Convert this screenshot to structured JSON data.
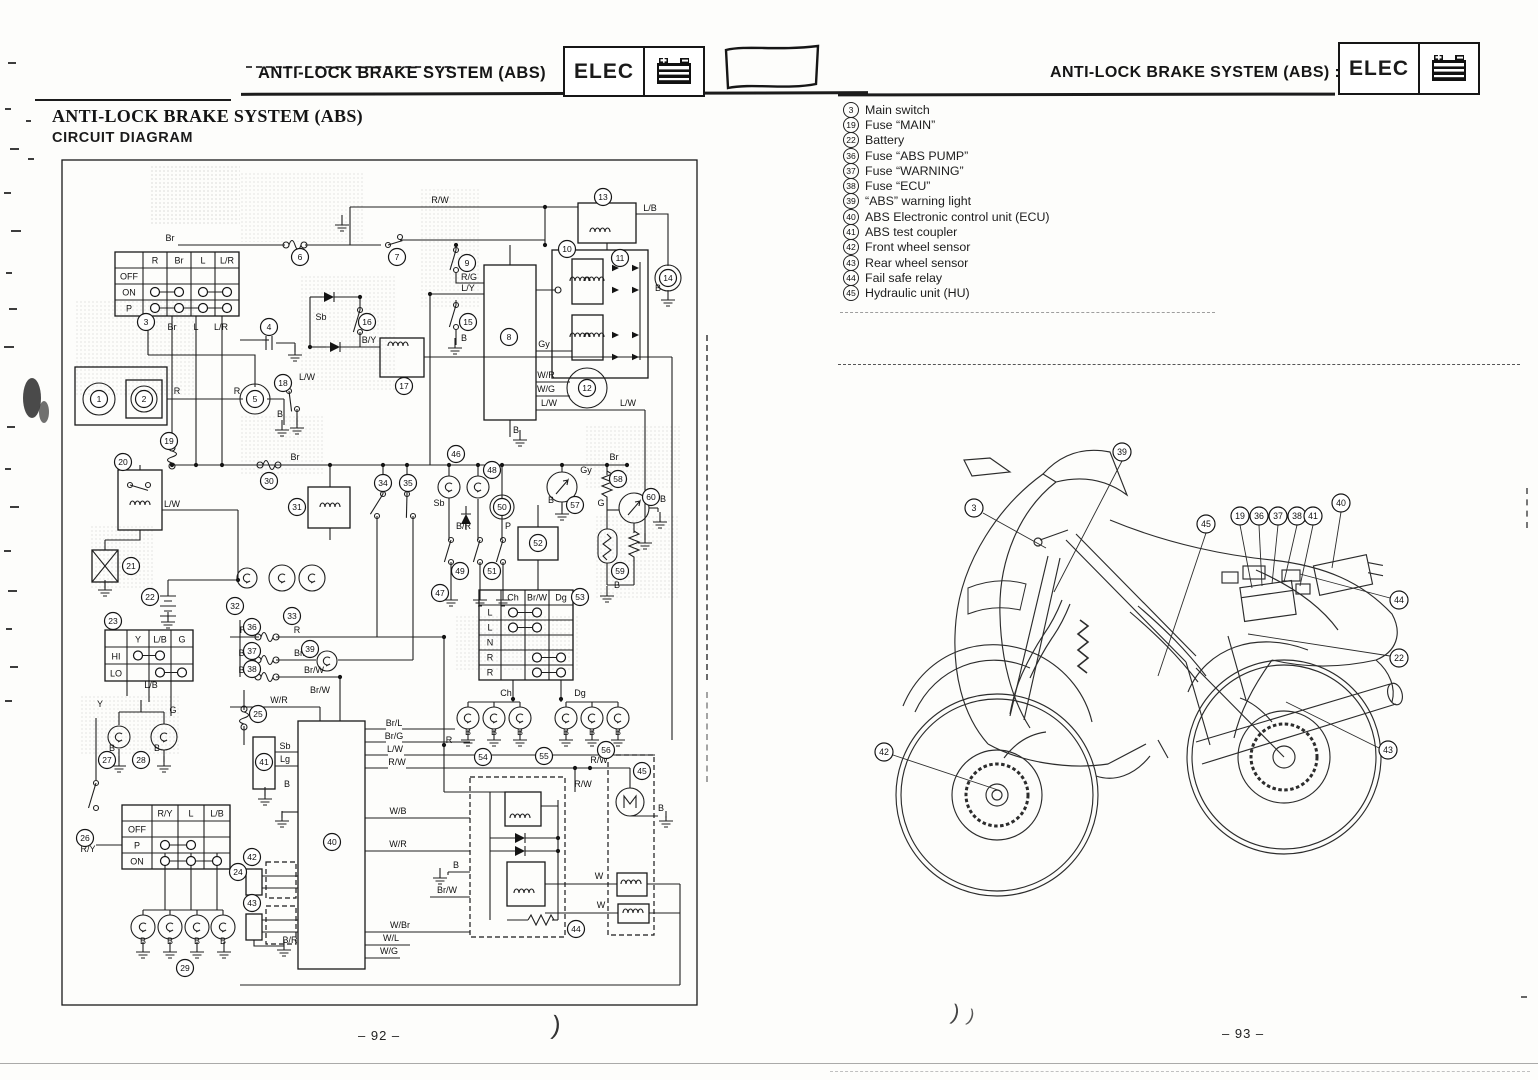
{
  "page_left": {
    "header_title": "ANTI-LOCK BRAKE SYSTEM (ABS)",
    "badge_label": "ELEC",
    "title_line1": "ANTI-LOCK BRAKE SYSTEM (ABS)",
    "title_line2": "CIRCUIT DIAGRAM",
    "page_number": "– 92 –"
  },
  "page_right": {
    "header_title": "ANTI-LOCK BRAKE SYSTEM (ABS) :",
    "badge_label": "ELEC",
    "page_number": "– 93 –",
    "legend": [
      {
        "num": "3",
        "label": "Main switch"
      },
      {
        "num": "19",
        "label": "Fuse “MAIN”"
      },
      {
        "num": "22",
        "label": "Battery"
      },
      {
        "num": "36",
        "label": "Fuse “ABS PUMP”"
      },
      {
        "num": "37",
        "label": "Fuse “WARNING”"
      },
      {
        "num": "38",
        "label": "Fuse “ECU”"
      },
      {
        "num": "39",
        "label": "“ABS” warning light"
      },
      {
        "num": "40",
        "label": "ABS Electronic control unit (ECU)"
      },
      {
        "num": "41",
        "label": "ABS test coupler"
      },
      {
        "num": "42",
        "label": "Front wheel sensor"
      },
      {
        "num": "43",
        "label": "Rear wheel sensor"
      },
      {
        "num": "44",
        "label": "Fail safe relay"
      },
      {
        "num": "45",
        "label": "Hydraulic unit (HU)"
      }
    ]
  },
  "circuit": {
    "callouts": [
      [
        1,
        99,
        399
      ],
      [
        2,
        144,
        399
      ],
      [
        3,
        146,
        322
      ],
      [
        4,
        269,
        327
      ],
      [
        5,
        255,
        399
      ],
      [
        6,
        300,
        257
      ],
      [
        7,
        397,
        257
      ],
      [
        8,
        509,
        337
      ],
      [
        9,
        467,
        263
      ],
      [
        10,
        567,
        249
      ],
      [
        11,
        620,
        258
      ],
      [
        12,
        587,
        388
      ],
      [
        13,
        603,
        197
      ],
      [
        14,
        668,
        278
      ],
      [
        15,
        468,
        322
      ],
      [
        16,
        367,
        322
      ],
      [
        17,
        404,
        386
      ],
      [
        18,
        283,
        383
      ],
      [
        19,
        169,
        441
      ],
      [
        20,
        123,
        462
      ],
      [
        21,
        131,
        566
      ],
      [
        22,
        150,
        597
      ],
      [
        23,
        113,
        621
      ],
      [
        24,
        238,
        872
      ],
      [
        25,
        258,
        714
      ],
      [
        26,
        85,
        838
      ],
      [
        27,
        107,
        760
      ],
      [
        28,
        141,
        760
      ],
      [
        29,
        185,
        968
      ],
      [
        30,
        269,
        481
      ],
      [
        31,
        297,
        507
      ],
      [
        32,
        235,
        606
      ],
      [
        33,
        292,
        616
      ],
      [
        34,
        383,
        483
      ],
      [
        35,
        408,
        483
      ],
      [
        36,
        252,
        627
      ],
      [
        37,
        252,
        651
      ],
      [
        38,
        252,
        669
      ],
      [
        39,
        310,
        649
      ],
      [
        40,
        332,
        842
      ],
      [
        41,
        264,
        762
      ],
      [
        42,
        252,
        857
      ],
      [
        43,
        252,
        903
      ],
      [
        44,
        576,
        929
      ],
      [
        45,
        642,
        771
      ],
      [
        46,
        456,
        454
      ],
      [
        47,
        440,
        593
      ],
      [
        48,
        492,
        470
      ],
      [
        49,
        460,
        571
      ],
      [
        50,
        502,
        507
      ],
      [
        51,
        492,
        571
      ],
      [
        52,
        538,
        543
      ],
      [
        53,
        580,
        597
      ],
      [
        54,
        483,
        757
      ],
      [
        55,
        544,
        756
      ],
      [
        56,
        606,
        750
      ],
      [
        57,
        575,
        505
      ],
      [
        58,
        618,
        479
      ],
      [
        59,
        620,
        571
      ],
      [
        60,
        651,
        497
      ]
    ],
    "labels": [
      [
        "R/W",
        440,
        203
      ],
      [
        "L/B",
        650,
        211
      ],
      [
        "Br",
        170,
        241
      ],
      [
        "R/G",
        469,
        280
      ],
      [
        "L/Y",
        468,
        291
      ],
      [
        "B",
        464,
        341
      ],
      [
        "Sb",
        321,
        320
      ],
      [
        "B/Y",
        369,
        343
      ],
      [
        "L/W",
        307,
        380
      ],
      [
        "B",
        280,
        417
      ],
      [
        "Gy",
        544,
        347
      ],
      [
        "W/R",
        546,
        378
      ],
      [
        "W/G",
        546,
        392
      ],
      [
        "L/W",
        549,
        406
      ],
      [
        "L/W",
        628,
        406
      ],
      [
        "B",
        516,
        433
      ],
      [
        "B",
        658,
        291
      ],
      [
        "R",
        177,
        394
      ],
      [
        "R",
        237,
        394
      ],
      [
        "R",
        148,
        330
      ],
      [
        "Br",
        172,
        330
      ],
      [
        "L",
        196,
        330
      ],
      [
        "L/R",
        221,
        330
      ],
      [
        "Br",
        295,
        460
      ],
      [
        "Br",
        614,
        460
      ],
      [
        "L/W",
        172,
        507
      ],
      [
        "L/B",
        151,
        688
      ],
      [
        "G",
        173,
        713
      ],
      [
        "R",
        243,
        633
      ],
      [
        "R",
        297,
        633
      ],
      [
        "Br",
        243,
        656
      ],
      [
        "Br/R",
        303,
        656
      ],
      [
        "Br",
        243,
        673
      ],
      [
        "Br/W",
        314,
        673
      ],
      [
        "Br/W",
        320,
        693
      ],
      [
        "W/R",
        279,
        703
      ],
      [
        "Br/L",
        394,
        726
      ],
      [
        "Br/G",
        394,
        739
      ],
      [
        "L/W",
        395,
        752
      ],
      [
        "R/W",
        397,
        765
      ],
      [
        "Sb",
        285,
        749
      ],
      [
        "Lg",
        285,
        762
      ],
      [
        "B",
        287,
        787
      ],
      [
        "W/B",
        398,
        814
      ],
      [
        "W/R",
        398,
        847
      ],
      [
        "B",
        456,
        868
      ],
      [
        "Br/W",
        447,
        893
      ],
      [
        "W/Br",
        400,
        928
      ],
      [
        "W/L",
        391,
        941
      ],
      [
        "W/G",
        389,
        954
      ],
      [
        "B/R",
        290,
        943
      ],
      [
        "R",
        449,
        743
      ],
      [
        "Ch",
        506,
        696
      ],
      [
        "Dg",
        580,
        696
      ],
      [
        "B",
        468,
        735
      ],
      [
        "B",
        494,
        735
      ],
      [
        "B",
        520,
        735
      ],
      [
        "B",
        566,
        735
      ],
      [
        "B",
        592,
        735
      ],
      [
        "B",
        618,
        735
      ],
      [
        "R/W",
        599,
        763
      ],
      [
        "R/W",
        583,
        787
      ],
      [
        "W",
        599,
        879
      ],
      [
        "W",
        601,
        908
      ],
      [
        "B",
        661,
        811
      ],
      [
        "Sb",
        439,
        506
      ],
      [
        "B/R",
        471,
        529,
        "end"
      ],
      [
        "P",
        508,
        529
      ],
      [
        "Gy",
        586,
        473
      ],
      [
        "B",
        551,
        503
      ],
      [
        "G",
        601,
        506
      ],
      [
        "B",
        617,
        588
      ],
      [
        "B",
        663,
        502
      ],
      [
        "Y",
        100,
        707
      ],
      [
        "R/Y",
        88,
        852
      ],
      [
        "B",
        112,
        751
      ],
      [
        "B",
        157,
        751
      ],
      [
        "B",
        143,
        944
      ],
      [
        "B",
        170,
        944
      ],
      [
        "B",
        197,
        944
      ],
      [
        "B",
        223,
        944
      ]
    ],
    "tables": [
      {
        "x": 115,
        "y": 252,
        "rl": 28,
        "cw": 24,
        "rh": 16,
        "cols": [
          "R",
          "Br",
          "L",
          "L/R"
        ],
        "rows": [
          "OFF",
          "ON",
          "P"
        ],
        "dots": [
          [
            1,
            0,
            1
          ],
          [
            1,
            2,
            3
          ],
          [
            2,
            0,
            3
          ]
        ]
      },
      {
        "x": 105,
        "y": 630,
        "rl": 22,
        "cw": 22,
        "rh": 17,
        "cols": [
          "Y",
          "L/B",
          "G"
        ],
        "rows": [
          "HI",
          "LO"
        ],
        "dots": [
          [
            0,
            0,
            1
          ],
          [
            1,
            1,
            2
          ]
        ]
      },
      {
        "x": 122,
        "y": 805,
        "rl": 30,
        "cw": 26,
        "rh": 16,
        "cols": [
          "R/Y",
          "L",
          "L/B"
        ],
        "rows": [
          "OFF",
          "P",
          "ON"
        ],
        "dots": [
          [
            1,
            0,
            1
          ],
          [
            2,
            0,
            2
          ]
        ]
      },
      {
        "x": 479,
        "y": 590,
        "rl": 22,
        "cw": 24,
        "rh": 15,
        "cols": [
          "Ch",
          "Br/W",
          "Dg"
        ],
        "rows": [
          "L",
          "L",
          "N",
          "R",
          "R"
        ],
        "dots": [
          [
            0,
            0,
            1
          ],
          [
            1,
            0,
            1
          ],
          [
            3,
            1,
            2
          ],
          [
            4,
            1,
            2
          ]
        ]
      }
    ]
  },
  "moto": {
    "callouts": [
      [
        "39",
        1122,
        452
      ],
      [
        "3",
        974,
        508
      ],
      [
        "45",
        1206,
        524
      ],
      [
        "19",
        1240,
        516
      ],
      [
        "36",
        1259,
        516
      ],
      [
        "37",
        1278,
        516
      ],
      [
        "38",
        1297,
        516
      ],
      [
        "41",
        1313,
        516
      ],
      [
        "40",
        1341,
        503
      ],
      [
        "44",
        1399,
        600
      ],
      [
        "22",
        1399,
        658
      ],
      [
        "42",
        884,
        752
      ],
      [
        "43",
        1388,
        750
      ]
    ],
    "leaders": [
      [
        1122,
        461,
        1054,
        592
      ],
      [
        983,
        513,
        1046,
        548
      ],
      [
        1206,
        533,
        1158,
        676
      ],
      [
        1240,
        525,
        1252,
        588
      ],
      [
        1259,
        525,
        1262,
        586
      ],
      [
        1278,
        525,
        1272,
        584
      ],
      [
        1297,
        525,
        1284,
        582
      ],
      [
        1313,
        525,
        1300,
        586
      ],
      [
        1341,
        512,
        1332,
        568
      ],
      [
        1390,
        598,
        1300,
        574
      ],
      [
        1390,
        656,
        1248,
        634
      ],
      [
        893,
        755,
        998,
        790
      ],
      [
        1379,
        748,
        1286,
        702
      ]
    ]
  }
}
